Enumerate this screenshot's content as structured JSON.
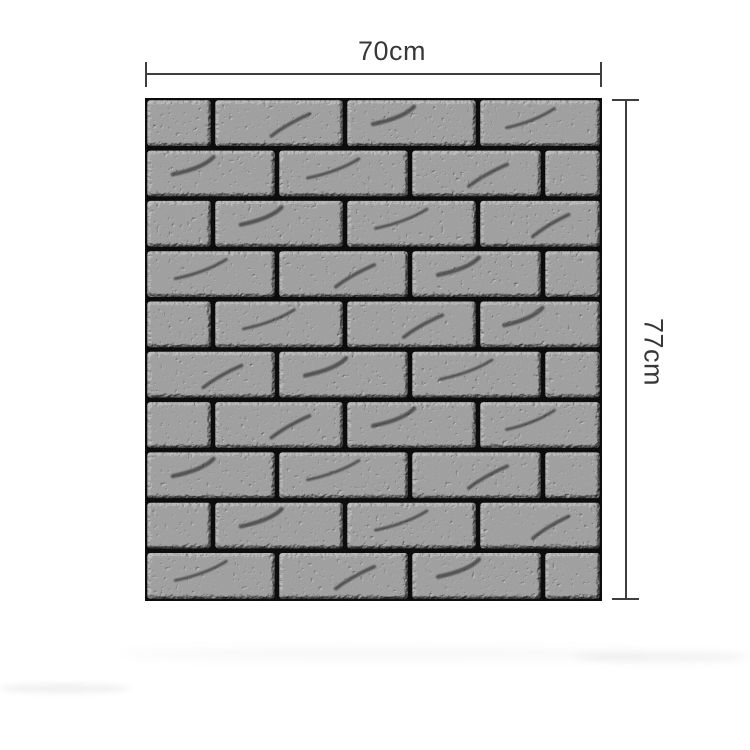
{
  "image": {
    "description": "black 3d brick wall panel with size annotations",
    "background_color": "#ffffff"
  },
  "dimensions": {
    "width": {
      "label": "70cm"
    },
    "height": {
      "label": "77cm"
    },
    "line_color": "#3e3e3e",
    "text_color": "#383838"
  },
  "panel": {
    "color_name": "black",
    "mortar_color": "#040404",
    "brick_base_color": "#131313",
    "brick_highlight_color": "#3a3a3a",
    "unit_width": 457,
    "unit_height": 503,
    "mortar_gap": 4.6,
    "row_sequence": [
      "A",
      "B",
      "A",
      "B",
      "A",
      "B",
      "A",
      "B",
      "A",
      "B"
    ],
    "row_patterns": {
      "A": [
        0,
        68,
        200,
        333,
        457
      ],
      "B": [
        0,
        132,
        265,
        398,
        457
      ]
    }
  },
  "shadow": {
    "color": "rgba(0,0,0,0.05)"
  }
}
